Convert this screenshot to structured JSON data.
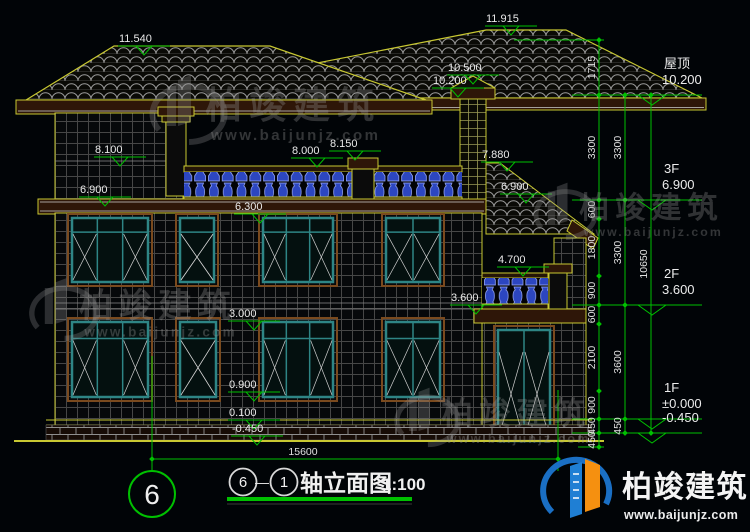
{
  "title": {
    "axis_from": "6",
    "separator": "—",
    "axis_to": "1",
    "name": "轴立面图",
    "scale": "1:100"
  },
  "axis_bubble": "6",
  "bottom_dimension": {
    "value": "15600"
  },
  "watermark": {
    "brand": "柏竣建筑",
    "url": "www.baijunjz.com"
  },
  "logo": {
    "brand": "柏竣建筑",
    "url": "www.baijunjz.com"
  },
  "colors": {
    "annotation_green": "#00c000",
    "cad_yellow": "#c8c832",
    "window_teal": "#2e8585",
    "baluster_blue": "#2c46c0",
    "logo_blue": "#1a6fc4",
    "logo_orange": "#f59010"
  },
  "floors": [
    {
      "name": "屋顶",
      "value": "10.200",
      "y": 95
    },
    {
      "name": "3F",
      "value": "6.900",
      "y": 200
    },
    {
      "name": "2F",
      "value": "3.600",
      "y": 305
    },
    {
      "name": "1F",
      "value": "±0.000",
      "y": 419
    },
    {
      "name": "",
      "value": "-0.450",
      "y": 433
    }
  ],
  "elevation_markers": [
    {
      "label": "11.540",
      "x": 145,
      "y": 46
    },
    {
      "label": "11.915",
      "x": 512,
      "y": 26
    },
    {
      "label": "10.500",
      "x": 474,
      "y": 75
    },
    {
      "label": "10.200",
      "x": 459,
      "y": 88
    },
    {
      "label": "8.100",
      "x": 121,
      "y": 157
    },
    {
      "label": "8.000",
      "x": 318,
      "y": 158
    },
    {
      "label": "8.150",
      "x": 356,
      "y": 151
    },
    {
      "label": "6.900",
      "x": 106,
      "y": 197
    },
    {
      "label": "6.300",
      "x": 261,
      "y": 214
    },
    {
      "label": "7.880",
      "x": 508,
      "y": 162
    },
    {
      "label": "6.900",
      "x": 527,
      "y": 194
    },
    {
      "label": "4.700",
      "x": 524,
      "y": 267
    },
    {
      "label": "3.600",
      "x": 477,
      "y": 305
    },
    {
      "label": "3.000",
      "x": 255,
      "y": 321
    },
    {
      "label": "0.900",
      "x": 255,
      "y": 392
    },
    {
      "label": "0.100",
      "x": 255,
      "y": 420
    },
    {
      "label": "-0.450",
      "x": 258,
      "y": 436
    }
  ],
  "dim_chains": [
    {
      "x": 599,
      "ticks": [
        40,
        95,
        200,
        219,
        276,
        305,
        324,
        391,
        419,
        433,
        447
      ],
      "labels": [
        "1715",
        "3300",
        "600",
        "1800",
        "900",
        "600",
        "2100",
        "900",
        "450",
        "450"
      ]
    },
    {
      "x": 625,
      "ticks": [
        95,
        200,
        305,
        419,
        433
      ],
      "labels": [
        "3300",
        "3300",
        "3600",
        "450"
      ]
    },
    {
      "x": 651,
      "ticks": [
        95,
        433
      ],
      "labels": [
        "10650"
      ]
    }
  ]
}
